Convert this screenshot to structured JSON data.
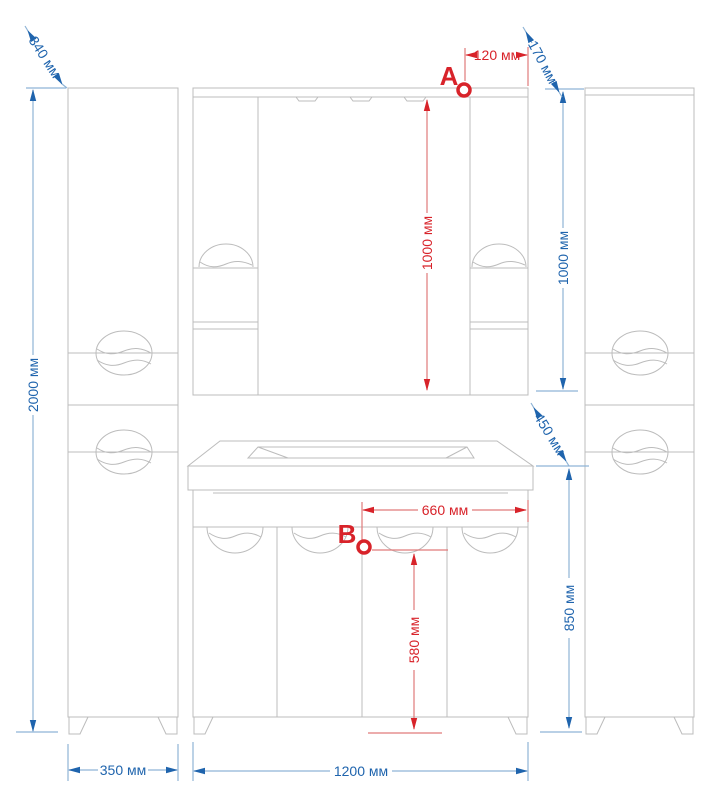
{
  "drawing": {
    "type": "furniture-dimension-drawing",
    "subject": "bathroom furniture set: two tall side cabinets, mirror cabinet, vanity with sink",
    "language": "ru",
    "units": "мм"
  },
  "colors": {
    "background": "#ffffff",
    "furniture_line": "#bcbcbc",
    "dimension_blue_text": "#1f64ad",
    "dimension_blue_line": "#8fb4d6",
    "dimension_red_text": "#d8232a",
    "dimension_red_line": "#e07a7a"
  },
  "dimensions": {
    "blue": {
      "left_cabinet_depth": "340 мм",
      "overall_height": "2000 мм",
      "left_cabinet_width": "350 мм",
      "vanity_width": "1200 мм",
      "mirror_cabinet_height": "1000 мм",
      "mirror_cabinet_depth": "170 мм",
      "countertop_depth": "450 мм",
      "vanity_height": "850 мм"
    },
    "red": {
      "point_a": "A",
      "point_a_offset": "120 мм",
      "mirror_height_at_a": "1000 мм",
      "point_b": "B",
      "point_b_offset": "660 мм",
      "point_b_floor_height": "580 мм"
    }
  }
}
